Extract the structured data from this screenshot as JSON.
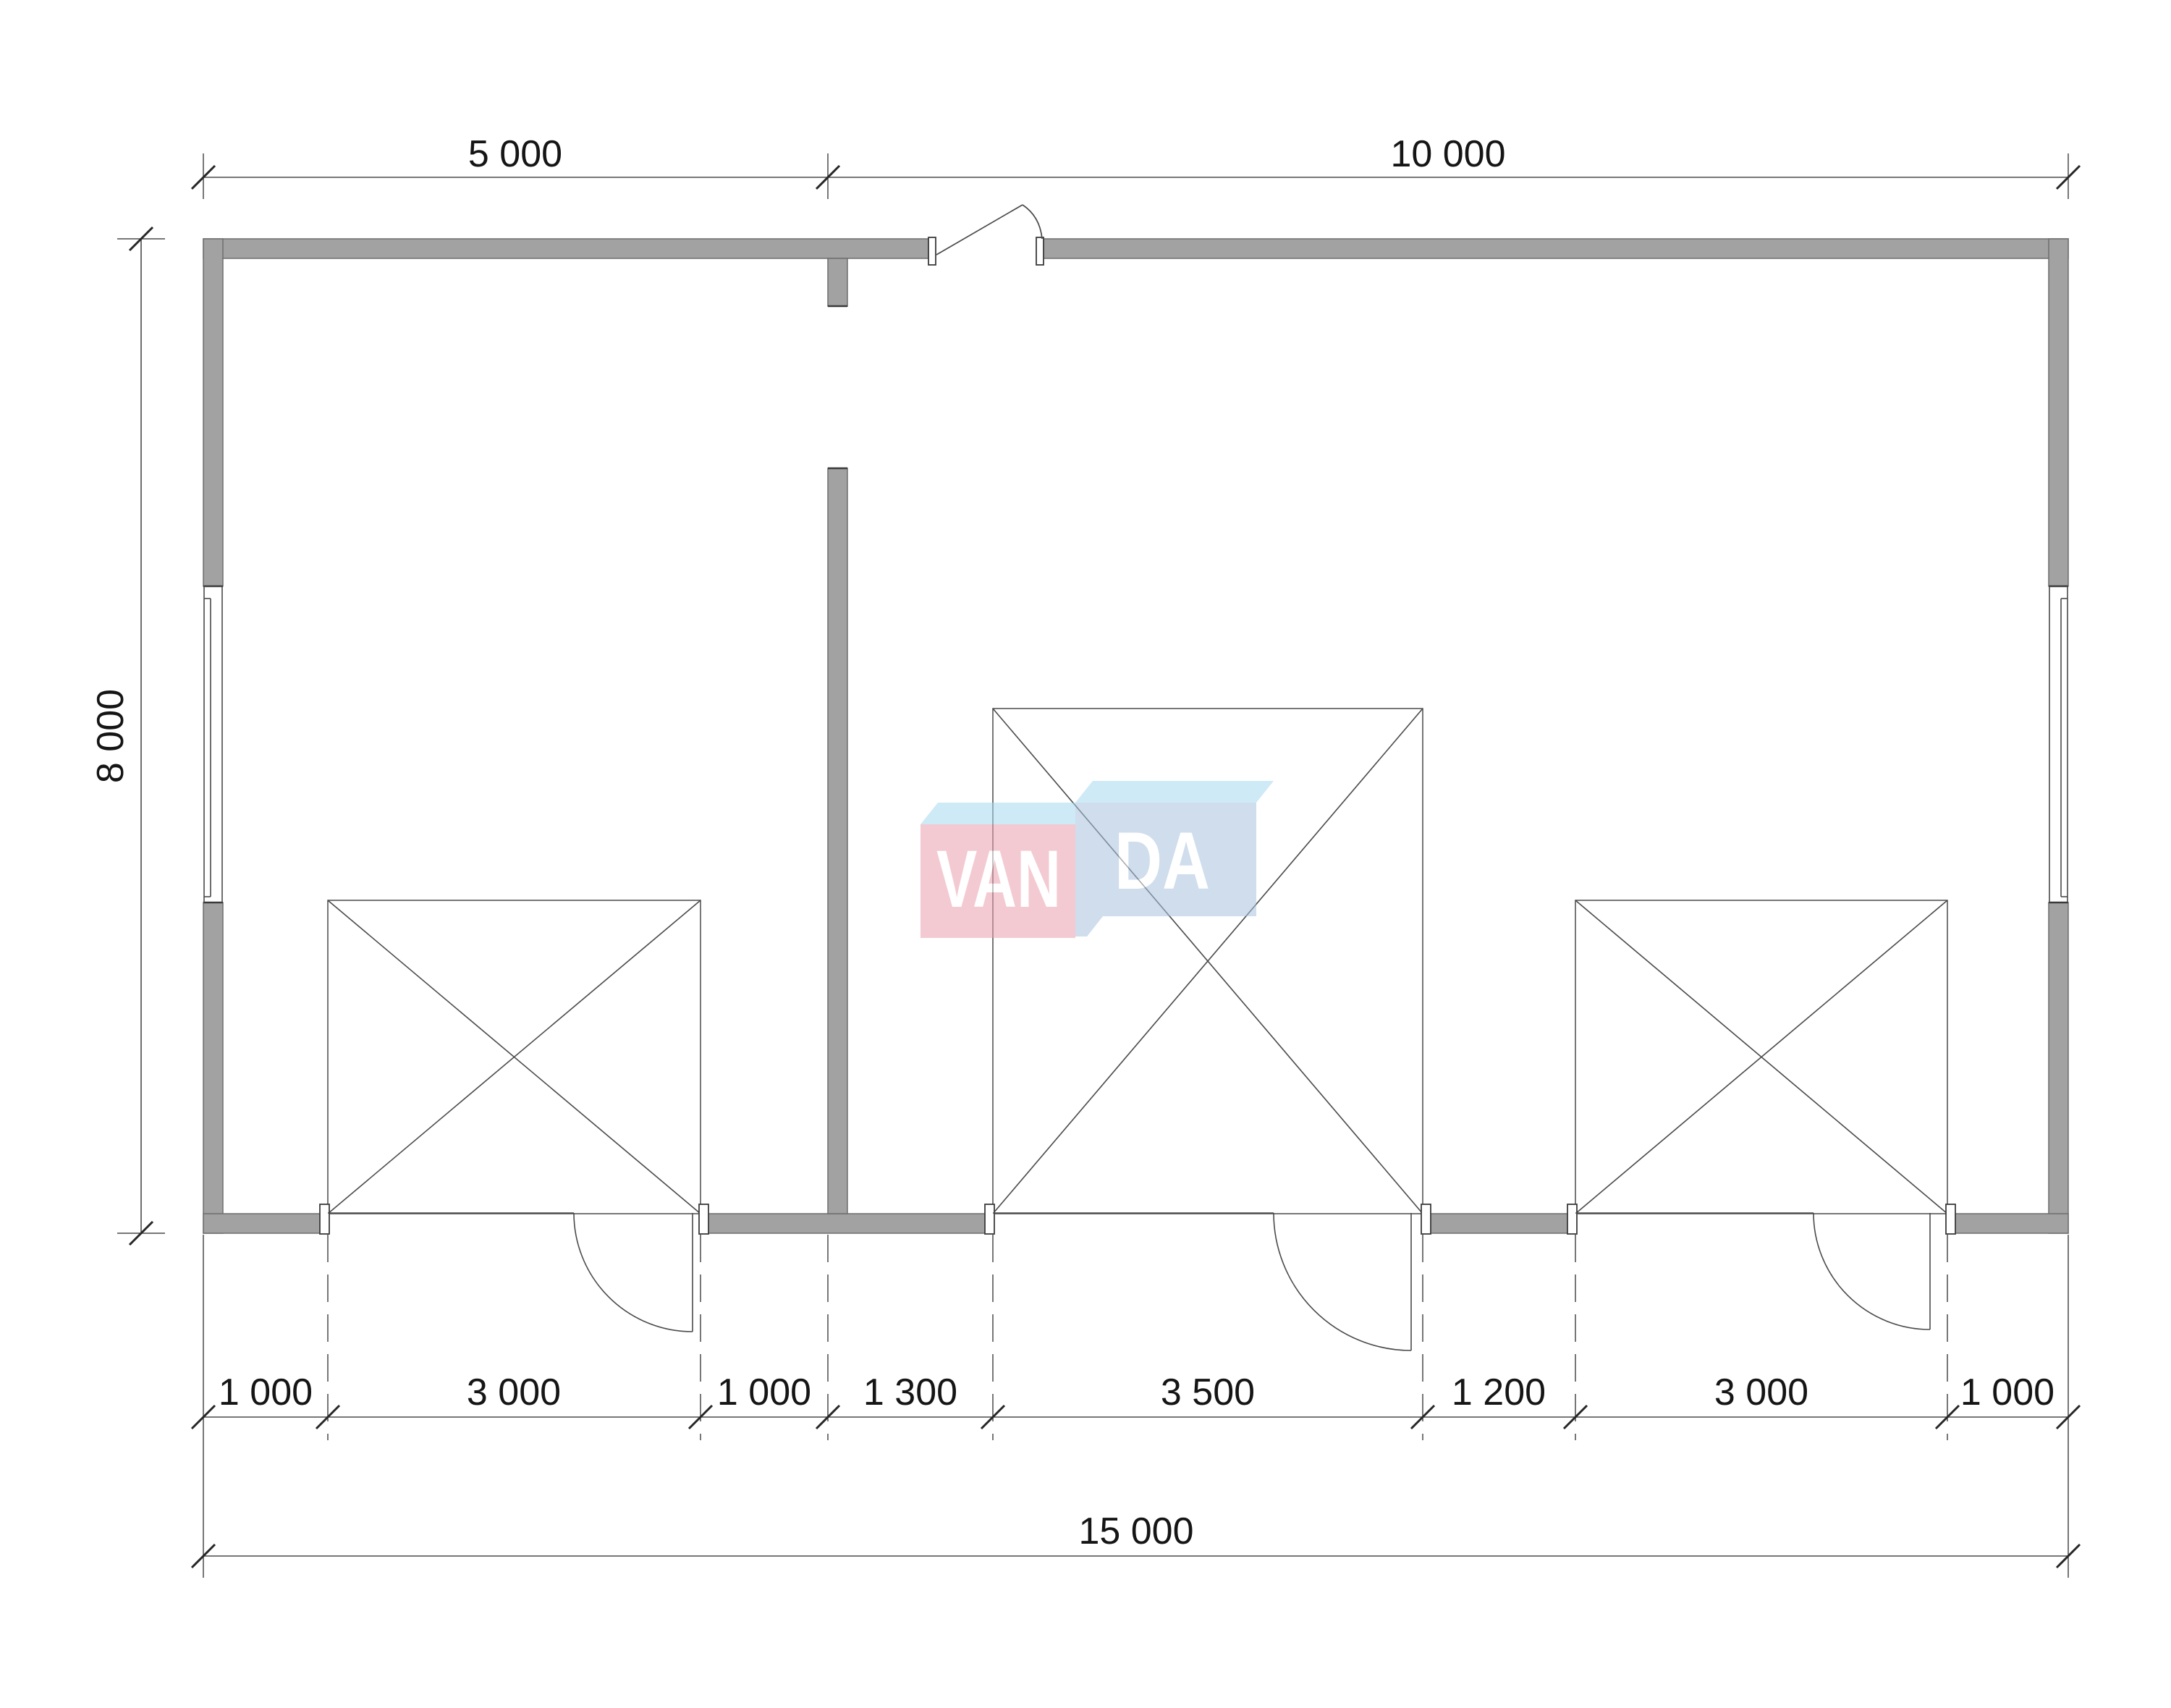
{
  "drawing": {
    "type": "architectural-floor-plan",
    "units": "mm",
    "colors": {
      "wall_fill": "#a2a2a2",
      "wall_edge": "#6e6e6e",
      "line": "#4a4a4a",
      "tick": "#262626",
      "text": "#151515",
      "watermark_pink": "#eb9fae",
      "watermark_top_blue": "#a6d9f0",
      "watermark_front_blue": "#a9c3de",
      "watermark_text": "#ffffff"
    },
    "dimensions": {
      "top": [
        {
          "label": "5 000"
        },
        {
          "label": "10 000"
        }
      ],
      "left": {
        "label": "8 000"
      },
      "bottom": [
        {
          "label": "1 000"
        },
        {
          "label": "3 000"
        },
        {
          "label": "1 000"
        },
        {
          "label": "1 300"
        },
        {
          "label": "3 500"
        },
        {
          "label": "1 200"
        },
        {
          "label": "3 000"
        },
        {
          "label": "1 000"
        }
      ],
      "overall": {
        "label": "15 000"
      }
    },
    "watermark": {
      "text_left": "VAN",
      "text_right": "DA"
    },
    "features": {
      "windows": [
        "window-left",
        "window-right"
      ],
      "doors": [
        "entry-door-top",
        "interior-opening",
        "garage-door-1",
        "garage-door-2",
        "garage-door-3"
      ]
    }
  }
}
